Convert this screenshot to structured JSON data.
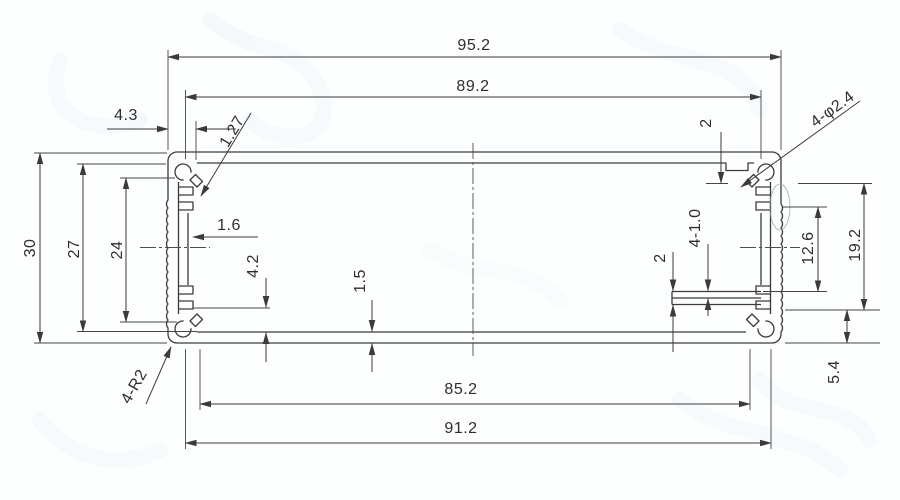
{
  "drawing_type": "technical-dimension-drawing",
  "subject": "extruded-enclosure-profile-cross-section",
  "dims": {
    "overall_width": "95.2",
    "top_opening": "89.2",
    "corner_boss_offset": "4.3",
    "boss_slot": "1.27",
    "top_step": "2",
    "corner_holes": "4-φ2.4",
    "overall_height": "30",
    "inner_height": "27",
    "wall_span": "24",
    "channel_width": "1.6",
    "corner_radius": "4-R2",
    "floor_ledge": "4.2",
    "wall_thickness": "1.5",
    "rail_pitch": "2",
    "card_slots": "4-1.0",
    "rail_offset": "12.6",
    "rail_height": "19.2",
    "base_offset": "5.4",
    "bottom_opening": "85.2",
    "bottom_width": "91.2"
  },
  "style": {
    "line_color": "#3b3b3b",
    "dim_line_color": "#454545",
    "background": "#fdfefe",
    "watermark_color": "#cde6f5"
  }
}
